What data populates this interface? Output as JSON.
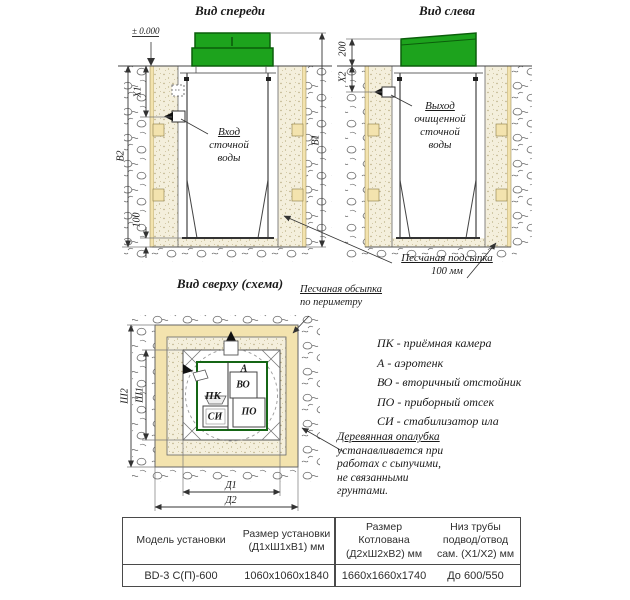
{
  "front_view": {
    "title": "Вид спереди",
    "zero_level": "± 0.000",
    "inlet_label": [
      "Вход",
      "сточной",
      "воды"
    ],
    "dims": {
      "x1": "X1",
      "b1": "В1",
      "b2": "В2",
      "bedding": "100"
    }
  },
  "left_view": {
    "title": "Вид слева",
    "outlet_label": [
      "Выход",
      "очищенной",
      "сточной",
      "воды"
    ],
    "dims": {
      "x2": "X2",
      "above_ground": "200"
    }
  },
  "bedding_note": {
    "line1": "Песчаная подсыпка",
    "line2": "100 мм"
  },
  "top_view": {
    "title": "Вид сверху (схема)",
    "backfill_note": [
      "Песчаная обсыпка",
      "по периметру"
    ],
    "dims": {
      "w1": "Ш1",
      "w2": "Ш2",
      "l1": "Д1",
      "l2": "Д2"
    },
    "compartments": {
      "pk": "ПК",
      "a": "А",
      "vo": "ВО",
      "po": "ПО",
      "si": "СИ"
    }
  },
  "legend": [
    "ПК - приёмная камера",
    "А - аэротенк",
    "ВО - вторичный отстойник",
    "ПО - приборный отсек",
    "СИ - стабилизатор ила"
  ],
  "formwork_note": [
    "Деревянная опалубка",
    "устанавливается при",
    "работах с сыпучими,",
    "не связанными",
    "грунтами."
  ],
  "table": {
    "headers": {
      "c1": [
        "Модель установки"
      ],
      "c2": [
        "Размер установки",
        "(Д1хШ1хВ1) мм"
      ],
      "c3": [
        "Размер",
        "Котлована",
        "(Д2хШ2хВ2) мм"
      ],
      "c4": [
        "Низ трубы",
        "подвод/отвод",
        "сам. (Х1/Х2) мм"
      ]
    },
    "row": [
      "BD-3 С(П)-600",
      "1060х1060х1840",
      "1660х1660х1740",
      "До 600/550"
    ]
  },
  "colors": {
    "lid_green": "#1da31d",
    "lid_green_dark": "#0b5e0b",
    "wood": "#f3e3ae",
    "sand": "#f4efdc"
  }
}
